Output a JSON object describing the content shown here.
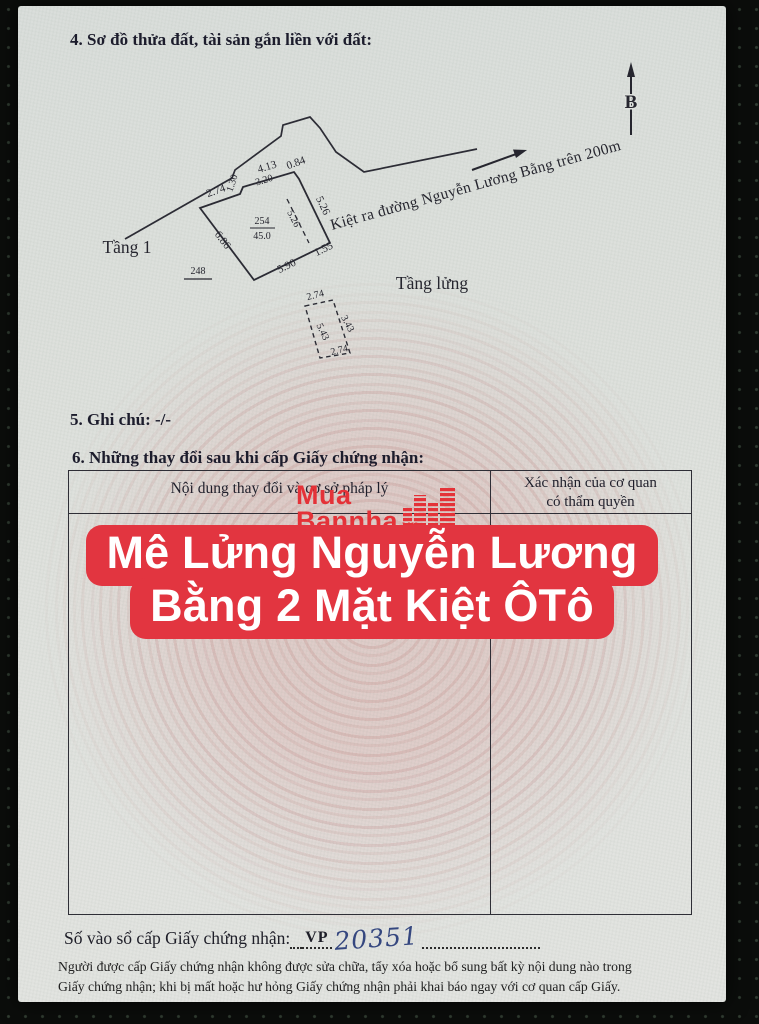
{
  "sections": {
    "s4_heading": "4. Sơ đồ thửa đất, tài sản gắn liền với đất:",
    "s5_text": "5. Ghi chú: -/-",
    "s6_heading": "6. Những thay đổi sau khi cấp Giấy chứng nhận:"
  },
  "diagram": {
    "north_label": "B",
    "floor1_label": "Tầng 1",
    "mezzanine_label": "Tầng lửng",
    "road_label": "Kiệt ra đường Nguyễn Lương Bằng trên 200m",
    "parcel_number": "254",
    "parcel_area": "45.0",
    "adjacent_parcel_number": "248",
    "measurements": {
      "top_left_edge": "2.74",
      "notch": "1.30",
      "top_edge": "4.13",
      "top_edge_inner": "3.20",
      "top_right_edge": "0.84",
      "right_edge": "5.26",
      "interior_split": "5.26",
      "left_edge": "6.86",
      "bottom_edge": "5.90",
      "bottom_right_edge": "1.55"
    },
    "mezzanine_measurements": {
      "top": "2.74",
      "right": "3.43",
      "left": "5.43",
      "bottom": "2.74"
    }
  },
  "table": {
    "col1_header": "Nội dung thay đổi và cơ sở pháp lý",
    "col2_header_line1": "Xác nhận của cơ quan",
    "col2_header_line2": "có thẩm quyền"
  },
  "watermark": {
    "line1": "Mua",
    "line2": "Bannha",
    "suffix": ".vn"
  },
  "banner": {
    "line1": "Mê Lửng Nguyễn Lương",
    "line2": "Bằng 2 Mặt Kiệt ÔTô"
  },
  "serial": {
    "label": "Số vào sổ cấp Giấy chứng nhận:",
    "prefix": "VP",
    "number": "20351"
  },
  "notice": {
    "line1": "Người được cấp Giấy chứng nhận không được sửa chữa, tẩy xóa hoặc bổ sung bất kỳ nội dung nào trong",
    "line2": "Giấy chứng nhận; khi bị mất hoặc hư hỏng Giấy chứng nhận phải khai báo ngay với cơ quan cấp Giấy."
  },
  "colors": {
    "banner_red": "#e23540",
    "watermark_red": "#e43238",
    "ink": "#1c1c2c",
    "handwriting_blue": "#35477f"
  }
}
